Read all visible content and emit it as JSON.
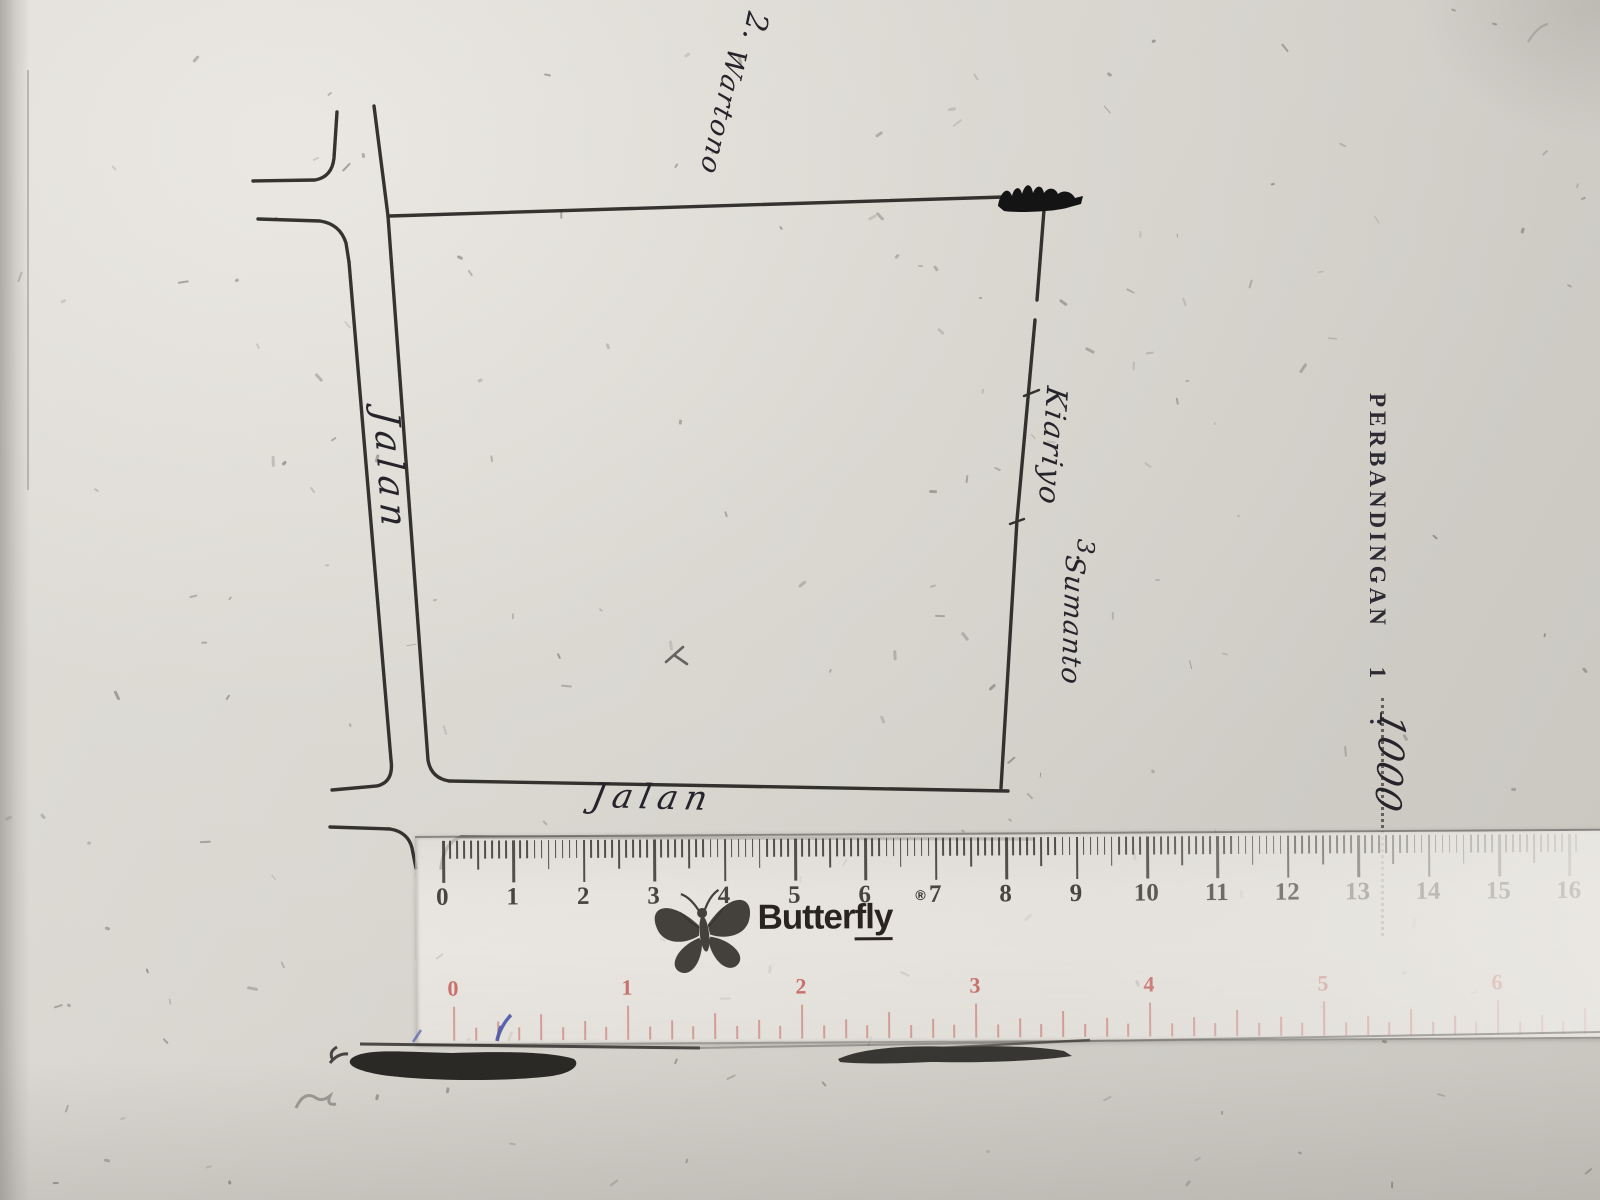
{
  "sketch": {
    "road_left_label": "Jalan",
    "road_bottom_label": "Jalan",
    "neighbor_top": {
      "number": "2.",
      "name": "Wartono"
    },
    "neighbor_right": {
      "name_line1": "Kiariyo",
      "number": "3.",
      "name_line2": "Sumanto"
    }
  },
  "scale_note": {
    "title": "PERBANDINGAN",
    "ratio_left": "1",
    "separator": ":",
    "ratio_right_handwritten": "1000"
  },
  "ruler": {
    "brand_plain": "Butter",
    "brand_underlined": "fly",
    "registered_mark": "®",
    "cm_labels": [
      "0",
      "1",
      "2",
      "3",
      "4",
      "5",
      "6",
      "7",
      "8",
      "9",
      "10",
      "11",
      "12",
      "13",
      "14",
      "15",
      "16"
    ],
    "inch_labels": [
      "0",
      "1",
      "2",
      "3",
      "4",
      "5",
      "6"
    ],
    "colors": {
      "cm_ink": "#332f2b",
      "inch_ink": "#c0524d",
      "body": "rgba(240,237,232,0.65)",
      "pen_mark": "#3f4da6"
    }
  }
}
